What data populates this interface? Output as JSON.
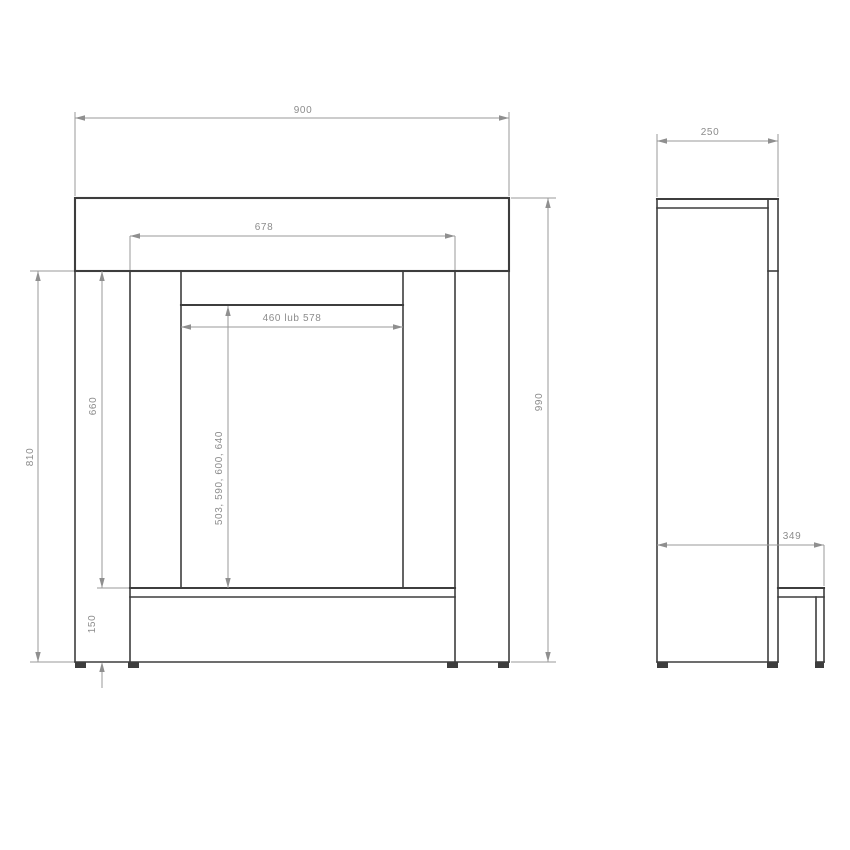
{
  "drawing": {
    "front_view": {
      "total_width": "900",
      "inner_width": "678",
      "opening_width": "460 lub 578",
      "total_height": "990",
      "body_height": "810",
      "opening_height": "660",
      "plinth_height": "150",
      "insert_heights": "503, 590, 600, 640"
    },
    "side_view": {
      "top_depth": "250",
      "base_depth": "349"
    },
    "colors": {
      "outline": "#3d3d3d",
      "dimension_lines": "#9a9a9a",
      "dimension_text": "#8c8c8c",
      "background": "#ffffff"
    }
  }
}
